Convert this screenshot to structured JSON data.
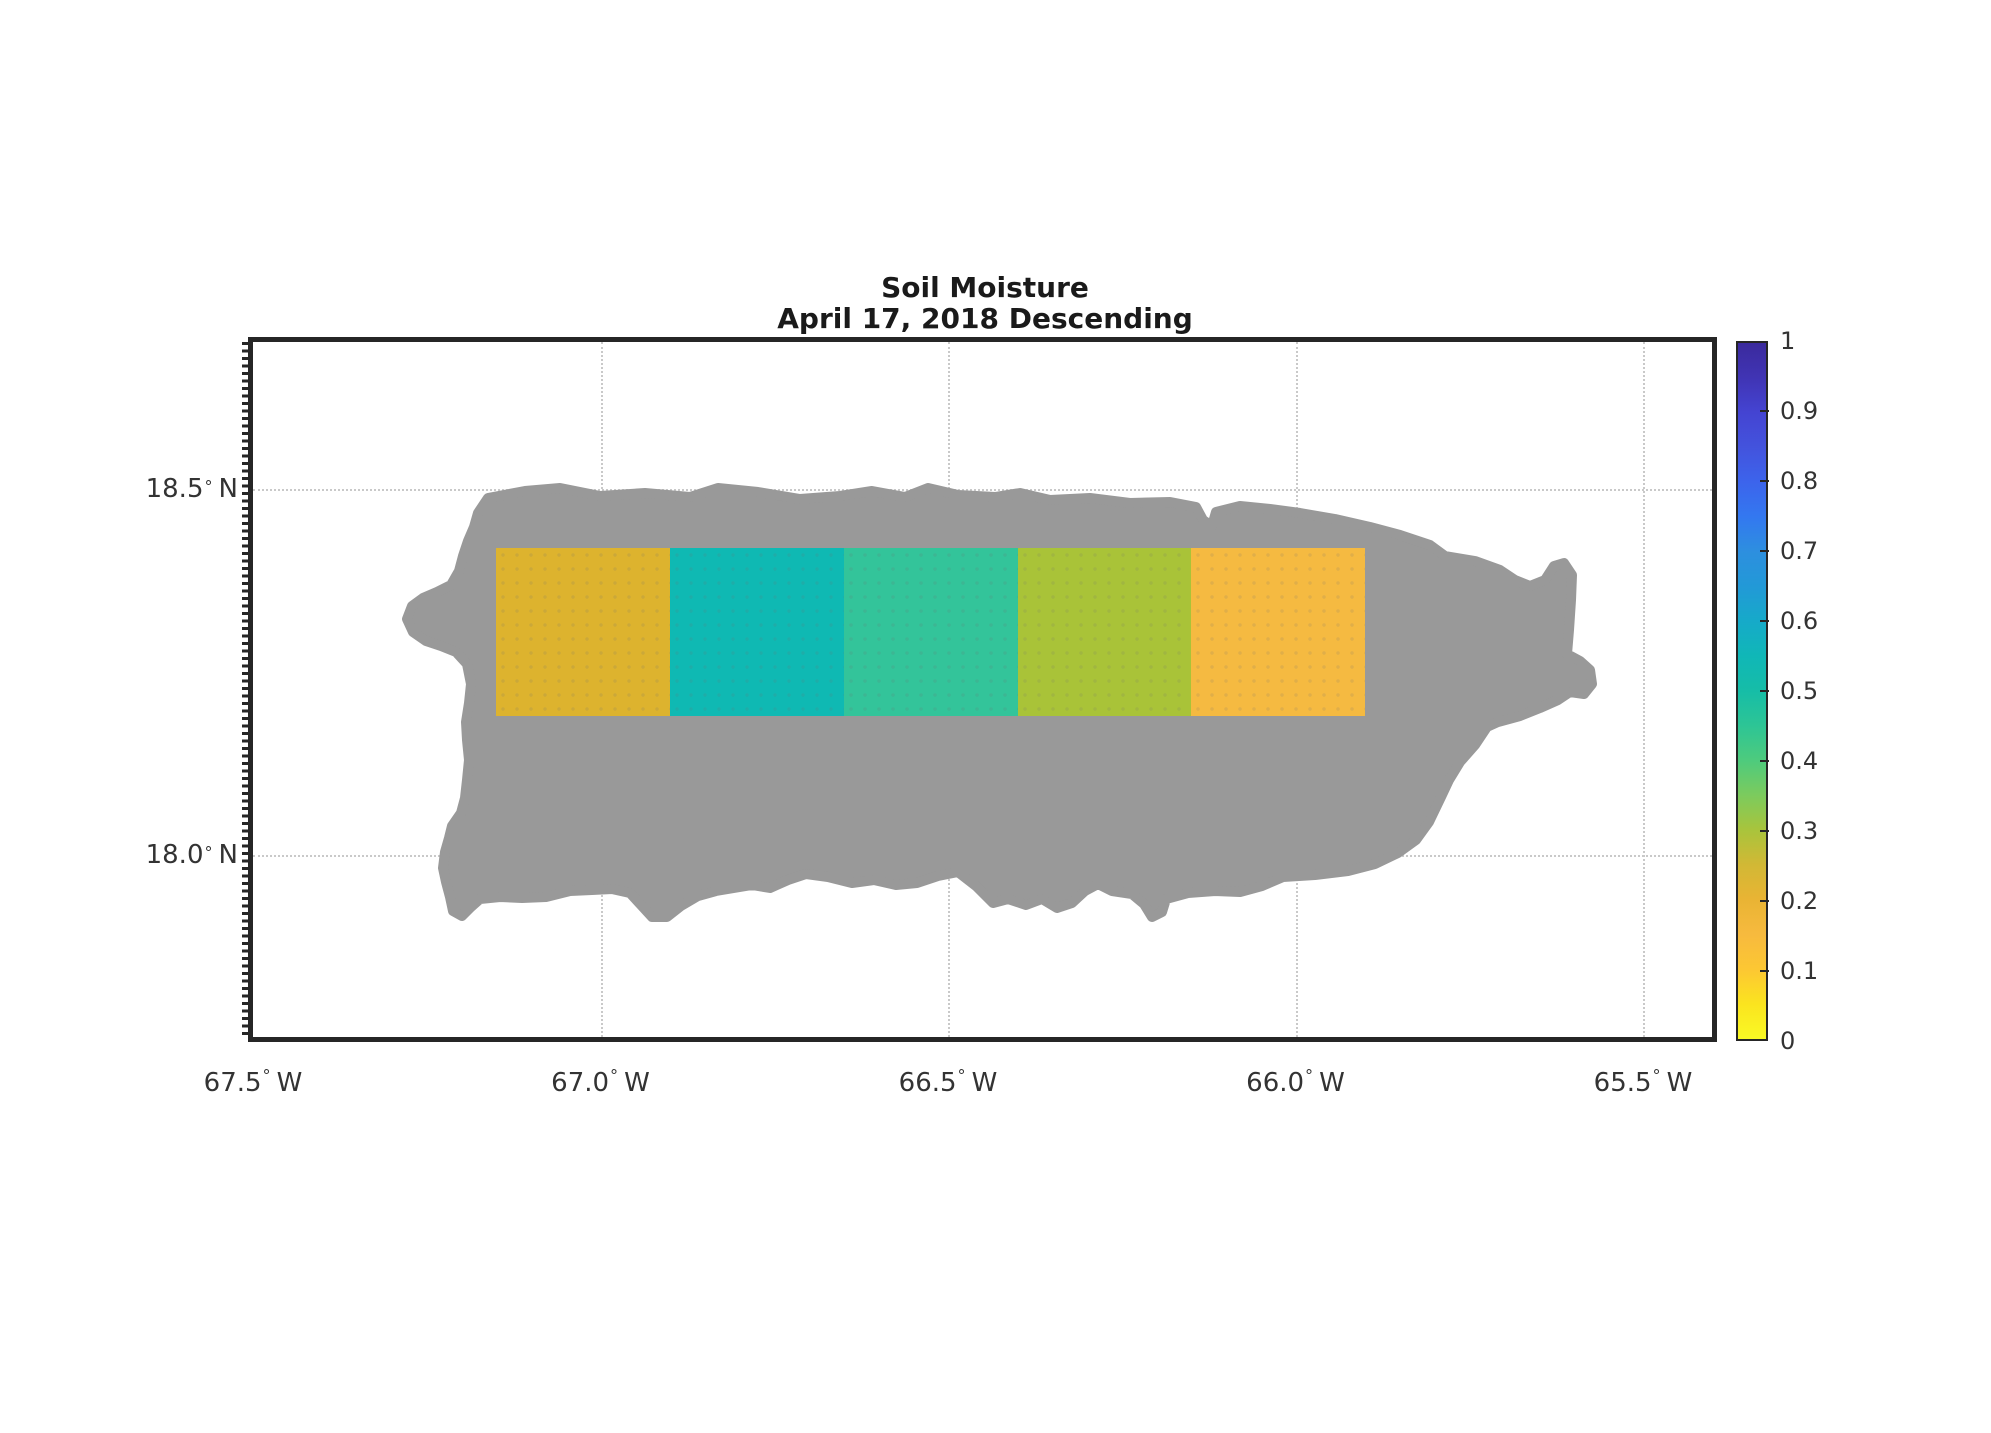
{
  "title": {
    "line1": "Soil Moisture",
    "line2": "April 17, 2018 Descending"
  },
  "axes": {
    "degree_symbol": "°",
    "x_ticks": [
      {
        "num": "67.5",
        "hemi": "W",
        "lon": -67.5
      },
      {
        "num": "67.0",
        "hemi": "W",
        "lon": -67.0
      },
      {
        "num": "66.5",
        "hemi": "W",
        "lon": -66.5
      },
      {
        "num": "66.0",
        "hemi": "W",
        "lon": -66.0
      },
      {
        "num": "65.5",
        "hemi": "W",
        "lon": -65.5
      }
    ],
    "y_ticks": [
      {
        "num": "18.5",
        "hemi": "N",
        "lat": 18.5
      },
      {
        "num": "18.0",
        "hemi": "N",
        "lat": 18.0
      }
    ],
    "grid_color": "#c9c9c9",
    "axis_color": "#262626"
  },
  "colorbar": {
    "min": 0,
    "max": 1,
    "ticks": [
      {
        "label": "1",
        "value": 1.0
      },
      {
        "label": "0.9",
        "value": 0.9
      },
      {
        "label": "0.8",
        "value": 0.8
      },
      {
        "label": "0.7",
        "value": 0.7
      },
      {
        "label": "0.6",
        "value": 0.6
      },
      {
        "label": "0.5",
        "value": 0.5
      },
      {
        "label": "0.4",
        "value": 0.4
      },
      {
        "label": "0.3",
        "value": 0.3
      },
      {
        "label": "0.2",
        "value": 0.2
      },
      {
        "label": "0.1",
        "value": 0.1
      },
      {
        "label": "0",
        "value": 0.0
      }
    ],
    "gradient": [
      [
        0.0,
        "#f9f924"
      ],
      [
        0.05,
        "#fbe41f"
      ],
      [
        0.1,
        "#fcc733"
      ],
      [
        0.15,
        "#f7ba3e"
      ],
      [
        0.2,
        "#e9b434"
      ],
      [
        0.25,
        "#d2b835"
      ],
      [
        0.3,
        "#a9c43c"
      ],
      [
        0.35,
        "#7ccb5d"
      ],
      [
        0.4,
        "#4ecb7d"
      ],
      [
        0.45,
        "#2dc595"
      ],
      [
        0.5,
        "#16bda7"
      ],
      [
        0.55,
        "#10b7b7"
      ],
      [
        0.6,
        "#16aac9"
      ],
      [
        0.65,
        "#2299d7"
      ],
      [
        0.7,
        "#2d8fdf"
      ],
      [
        0.75,
        "#3378f0"
      ],
      [
        0.8,
        "#3c64ec"
      ],
      [
        0.85,
        "#4353dd"
      ],
      [
        0.9,
        "#4444d2"
      ],
      [
        0.95,
        "#4034b4"
      ],
      [
        1.0,
        "#3b2a9d"
      ]
    ]
  },
  "chart_data": {
    "type": "heatmap",
    "title": "Soil Moisture",
    "subtitle": "April 17, 2018 Descending",
    "region": "Puerto Rico",
    "basemap_color": "#999999",
    "colormap": "parula-reversed",
    "value_range": [
      0,
      1
    ],
    "lon_axis_range": [
      -67.51,
      -65.41
    ],
    "lat_axis_range": [
      17.75,
      18.7
    ],
    "cells": [
      {
        "lon_min": -67.15,
        "lon_max": -66.9,
        "lat_min": 18.19,
        "lat_max": 18.42,
        "value": 0.23,
        "color": "#ddb32e"
      },
      {
        "lon_min": -66.9,
        "lon_max": -66.65,
        "lat_min": 18.19,
        "lat_max": 18.42,
        "value": 0.55,
        "color": "#0fb9b3"
      },
      {
        "lon_min": -66.65,
        "lon_max": -66.4,
        "lat_min": 18.19,
        "lat_max": 18.42,
        "value": 0.46,
        "color": "#33c49a"
      },
      {
        "lon_min": -66.4,
        "lon_max": -66.15,
        "lat_min": 18.19,
        "lat_max": 18.42,
        "value": 0.3,
        "color": "#a9c338"
      },
      {
        "lon_min": -66.15,
        "lon_max": -65.9,
        "lat_min": 18.19,
        "lat_max": 18.42,
        "value": 0.15,
        "color": "#f5ba41"
      }
    ]
  }
}
